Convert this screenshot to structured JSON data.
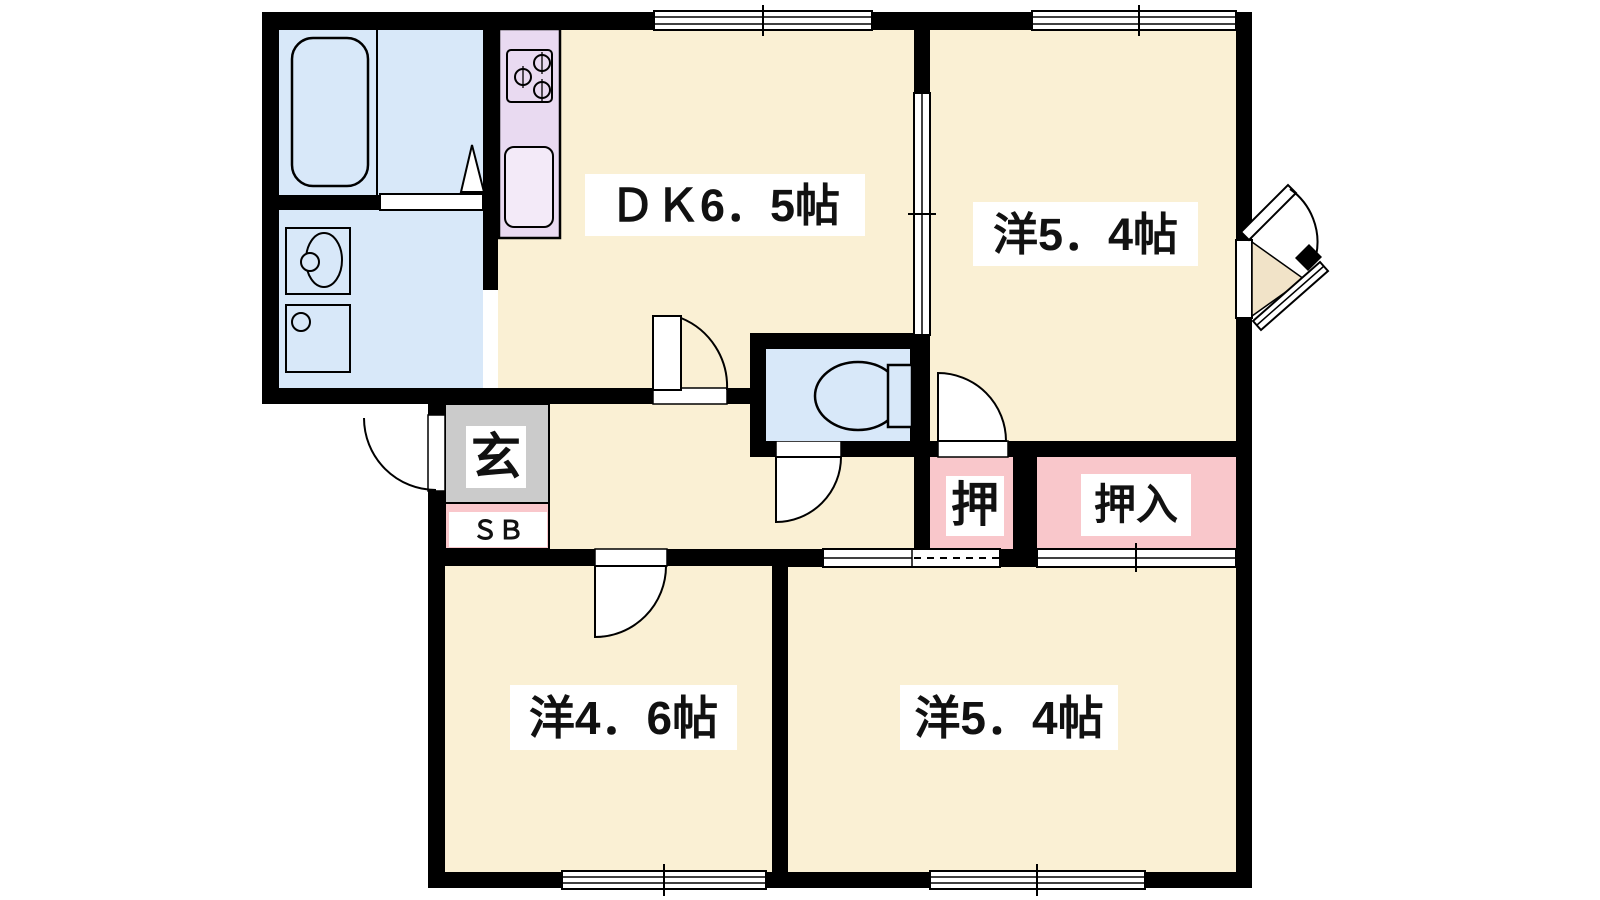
{
  "plan": {
    "labels": {
      "dk": "ＤＫ6．5帖",
      "western_top_right": "洋5．4帖",
      "western_bottom_left": "洋4．6帖",
      "western_bottom_right": "洋5．4帖",
      "entrance": "玄",
      "shoe_box": "ＳＢ",
      "closet_small": "押",
      "closet_large": "押入"
    },
    "colors": {
      "wall": "#000000",
      "floor_cream": "#FAF0D4",
      "wet_area_blue": "#D8E8F9",
      "kitchen_purple": "#E9DAF1",
      "closet_pink": "#F9C7CB",
      "entrance_gray": "#CBCBCB",
      "entry_step_beige": "#F1E3C8",
      "background": "#FFFFFF"
    }
  }
}
